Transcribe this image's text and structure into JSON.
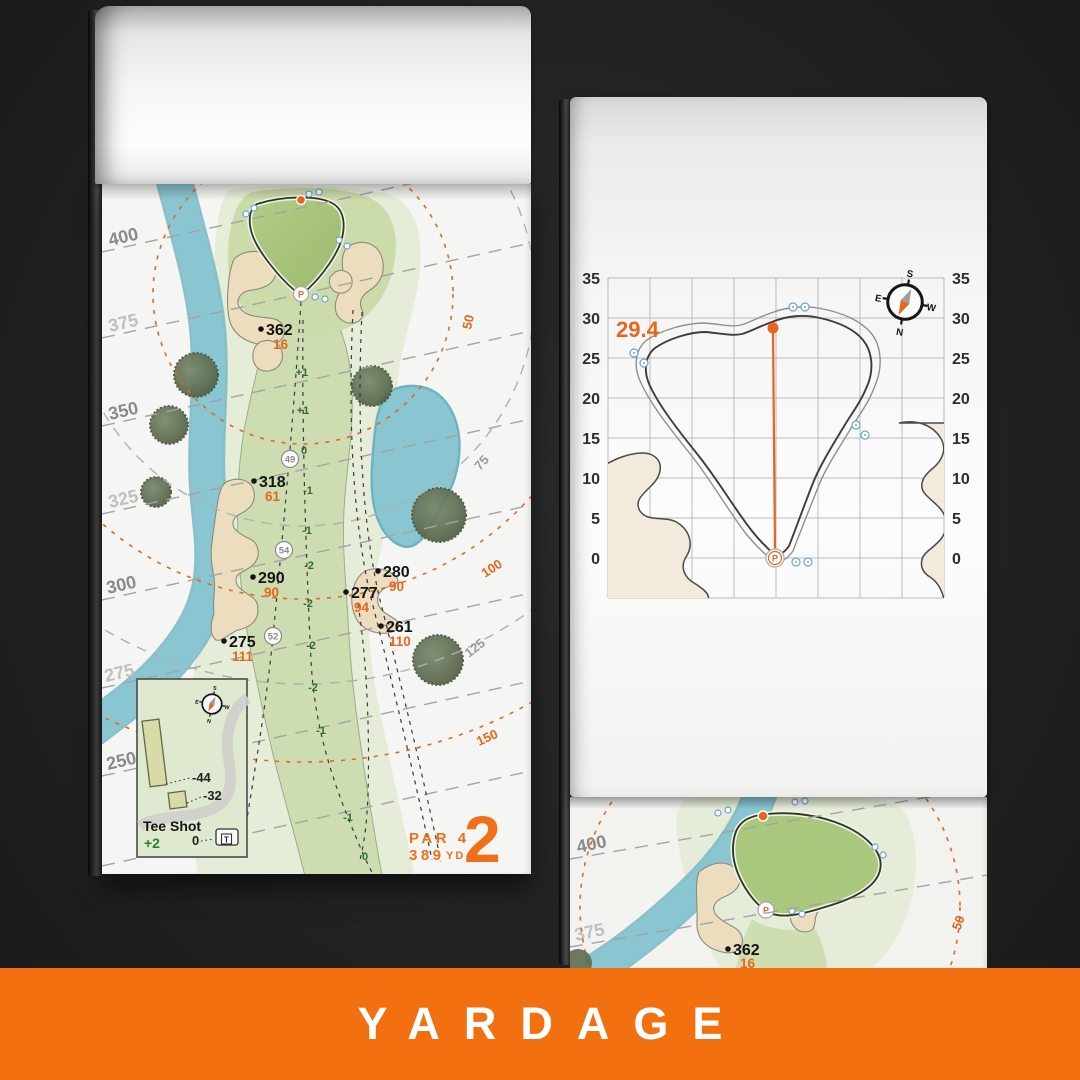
{
  "banner": {
    "title": "YARDAGE"
  },
  "pin": "P",
  "compass": {
    "n": "N",
    "s": "S",
    "e": "E",
    "w": "W"
  },
  "colors": {
    "banner_bg": "#F2700F",
    "accent_orange": "#E8661B",
    "water": "#8AC6D2",
    "fairway": "#CDDCB0",
    "green": "#A9C67D",
    "sand": "#EBDDBD",
    "slope_green": "#2F6B35"
  },
  "hole_map": {
    "tee_distance_lines": [
      "400",
      "375",
      "350",
      "325",
      "300",
      "275",
      "250"
    ],
    "green_distance_arcs": [
      "50",
      "75",
      "100",
      "125",
      "150"
    ],
    "points": [
      {
        "distance": "362",
        "to_green": "16"
      },
      {
        "distance": "318",
        "to_green": "61"
      },
      {
        "distance": "290",
        "to_green": "90"
      },
      {
        "distance": "275",
        "to_green": "111"
      },
      {
        "distance": "280",
        "to_green": "90"
      },
      {
        "distance": "277",
        "to_green": "94"
      },
      {
        "distance": "261",
        "to_green": "110"
      }
    ],
    "sprinklers": [
      "49",
      "54",
      "52"
    ],
    "slopes": [
      "+1",
      "+1",
      "0",
      "-1",
      "-1",
      "-2",
      "-2",
      "-2",
      "-2",
      "-1",
      "-1",
      "0"
    ],
    "inset": {
      "title": "Tee Shot",
      "value": "+2",
      "mark_44": "-44",
      "mark_32": "-32",
      "mark_0": "0",
      "tee_icon": "T"
    },
    "hole_info": {
      "par": "PAR 4",
      "yardage": "389",
      "unit": "YD",
      "number": "2"
    }
  },
  "green_chart": {
    "depth_value": "29.4",
    "axis_ticks": [
      "35",
      "30",
      "25",
      "20",
      "15",
      "10",
      "5",
      "0"
    ]
  },
  "next_page": {
    "tee_line_400": "400",
    "tee_line_375": "375",
    "point_distance": "362",
    "point_to_green": "16",
    "arc_50": "50"
  }
}
